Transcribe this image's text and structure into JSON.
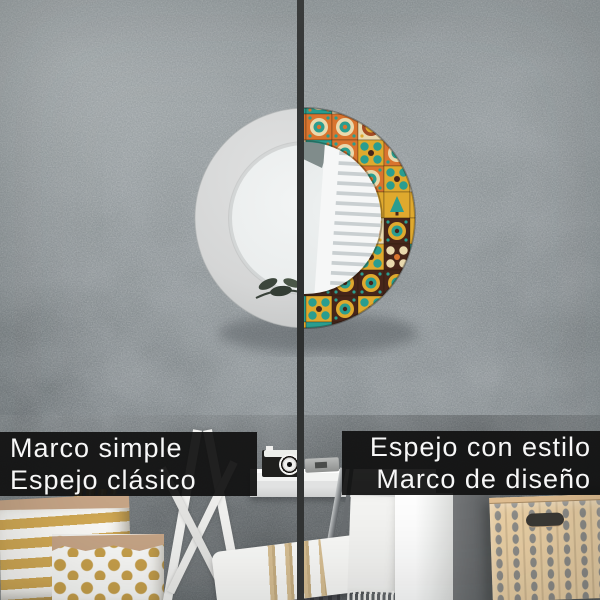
{
  "panels": {
    "left": {
      "line1": "Marco simple",
      "line2": "Espejo clásico"
    },
    "right": {
      "line1": "Espejo con estilo",
      "line2": "Marco de diseño"
    }
  },
  "palette": {
    "wall": "#8b9295",
    "wall_light": "#9aa1a3",
    "wall_dark": "#6d7478",
    "divider": "#323434",
    "bar_bg": "#111111",
    "bar_text": "#f7f7f7",
    "frame_white": "#d6d7d7",
    "glass": "#edf0f0",
    "reflection": "#e3e6e6",
    "window_white": "#f6f7f7",
    "slat_gray": "#c9cfd1",
    "tile_teal": "#2a9d8f",
    "tile_orange": "#d9742f",
    "tile_mustard": "#dfa92e",
    "tile_brown": "#46251a",
    "tile_cream": "#e9d9ae",
    "tile_rust": "#a34b24",
    "gold": "#c9a14b",
    "kraft": "#c8a687",
    "basket_bg": "#ebd0a5",
    "basket_motif": "#8d8c88",
    "chrome": "#85898c",
    "pillow_stripe": "#d9c094"
  }
}
